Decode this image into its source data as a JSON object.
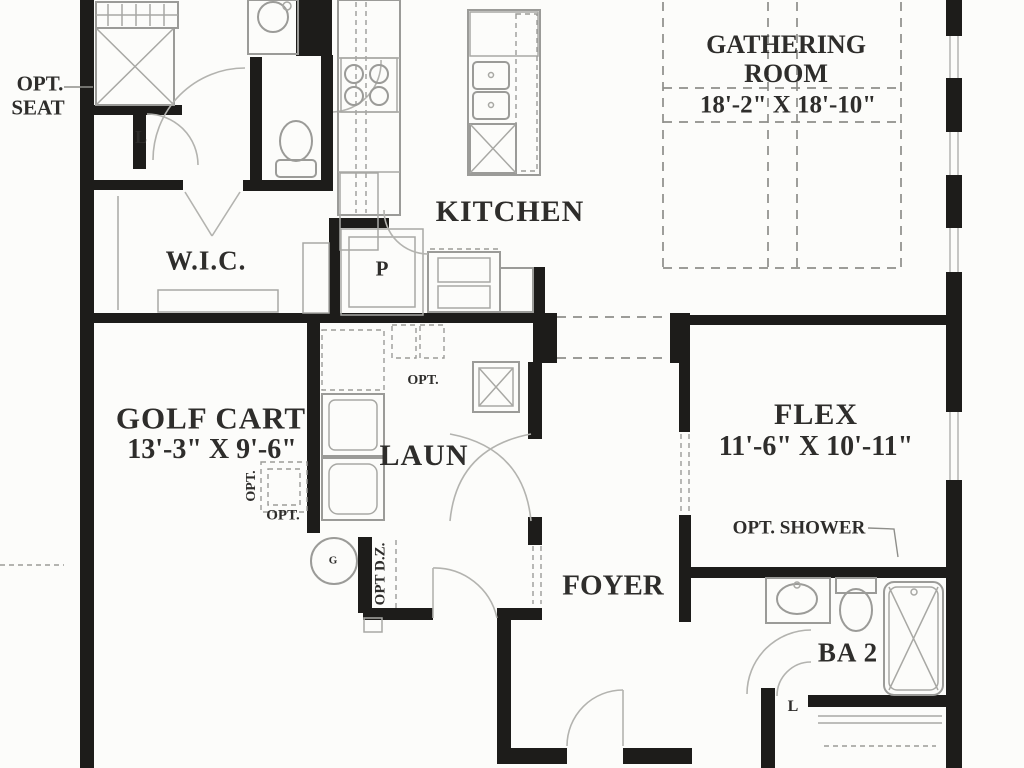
{
  "document": {
    "type": "architectural-floor-plan",
    "style": "black-and-white scanned blueprint, first floor partial view"
  },
  "colors": {
    "wall": "#1d1c1a",
    "fixture_line": "#9b9b98",
    "dashed_line": "#8e8e8a",
    "text": "#2e2d2b",
    "background": "#fcfcfa"
  },
  "rooms": {
    "gathering": {
      "name_line1": "GATHERING",
      "name_line2": "ROOM",
      "dimensions": "18'-2\" X 18'-10\""
    },
    "kitchen": {
      "name": "KITCHEN"
    },
    "wic": {
      "name": "W.I.C."
    },
    "golf_cart": {
      "name": "GOLF CART",
      "dimensions": "13'-3\" X 9'-6\""
    },
    "laundry": {
      "name": "LAUN"
    },
    "flex": {
      "name": "FLEX",
      "dimensions": "11'-6\" X 10'-11\""
    },
    "foyer": {
      "name": "FOYER"
    },
    "bath2": {
      "name": "BA 2"
    }
  },
  "annotations": {
    "opt_seat_line1": "OPT.",
    "opt_seat_line2": "SEAT",
    "opt_shower": "OPT. SHOWER",
    "pantry": "P",
    "linen_upper": "L",
    "linen_lower": "L",
    "opt_golf_cart_vertical": "OPT.",
    "opt_golf_cart_horizontal": "OPT.",
    "opt_laundry_cabinets": "OPT.",
    "opt_drop_zone": "OPT D.Z.",
    "gas": "G"
  }
}
